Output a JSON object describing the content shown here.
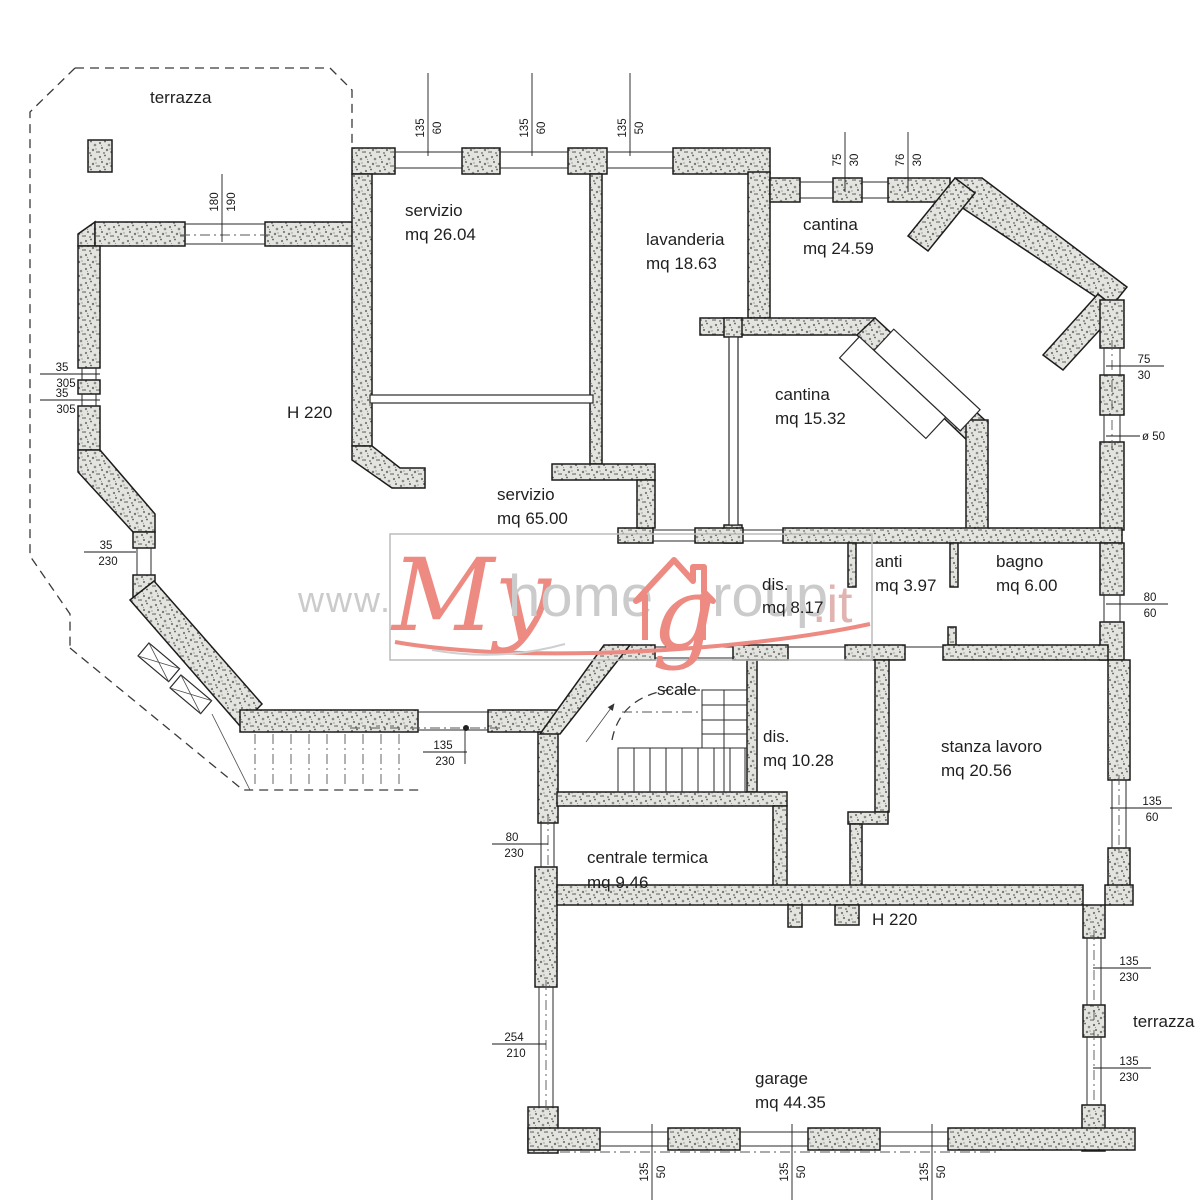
{
  "plan": {
    "rooms": [
      {
        "id": "terrazza-top",
        "name": "terrazza",
        "area": ""
      },
      {
        "id": "servizio-26",
        "name": "servizio",
        "area": "mq 26.04"
      },
      {
        "id": "lavanderia",
        "name": "lavanderia",
        "area": "mq 18.63"
      },
      {
        "id": "cantina-24",
        "name": "cantina",
        "area": "mq 24.59"
      },
      {
        "id": "cantina-15",
        "name": "cantina",
        "area": "mq 15.32"
      },
      {
        "id": "height-note-1",
        "name": "H 220",
        "area": ""
      },
      {
        "id": "servizio-65",
        "name": "servizio",
        "area": "mq 65.00"
      },
      {
        "id": "dis-8",
        "name": "dis.",
        "area": "mq 8.17"
      },
      {
        "id": "anti",
        "name": "anti",
        "area": "mq 3.97"
      },
      {
        "id": "bagno",
        "name": "bagno",
        "area": "mq 6.00"
      },
      {
        "id": "scale",
        "name": "scale",
        "area": ""
      },
      {
        "id": "dis-10",
        "name": "dis.",
        "area": "mq 10.28"
      },
      {
        "id": "stanza-lavoro",
        "name": "stanza lavoro",
        "area": "mq 20.56"
      },
      {
        "id": "centrale-termica",
        "name": "centrale termica",
        "area": "mq 9.46"
      },
      {
        "id": "height-note-2",
        "name": "H 220",
        "area": ""
      },
      {
        "id": "garage",
        "name": "garage",
        "area": "mq 44.35"
      },
      {
        "id": "terrazza-bottom",
        "name": "terrazza",
        "area": ""
      }
    ],
    "dims": [
      {
        "a": "135",
        "b": "60"
      },
      {
        "a": "135",
        "b": "60"
      },
      {
        "a": "135",
        "b": "50"
      },
      {
        "a": "75",
        "b": "30"
      },
      {
        "a": "76",
        "b": "30"
      },
      {
        "a": "180",
        "b": "190"
      },
      {
        "a": "35",
        "b": "305"
      },
      {
        "a": "35",
        "b": "305"
      },
      {
        "a": "35",
        "b": "230"
      },
      {
        "a": "75",
        "b": "30"
      },
      {
        "label": "ø 50"
      },
      {
        "a": "80",
        "b": "60"
      },
      {
        "a": "135",
        "b": "60"
      },
      {
        "a": "135",
        "b": "230"
      },
      {
        "a": "80",
        "b": "230"
      },
      {
        "a": "254",
        "b": "210"
      },
      {
        "a": "135",
        "b": "230"
      },
      {
        "a": "135",
        "b": "230"
      },
      {
        "a": "135",
        "b": "50"
      },
      {
        "a": "135",
        "b": "50"
      },
      {
        "a": "135",
        "b": "50"
      }
    ]
  },
  "watermark": {
    "prefix": "www.",
    "my": "My",
    "home": "home",
    "g": "g",
    "roup": "roup",
    "suffix": ".it"
  },
  "colors": {
    "accent": "#ed8a82",
    "wall_outline": "#1c1c1c",
    "watermark_gray": "#cbcbcb"
  }
}
